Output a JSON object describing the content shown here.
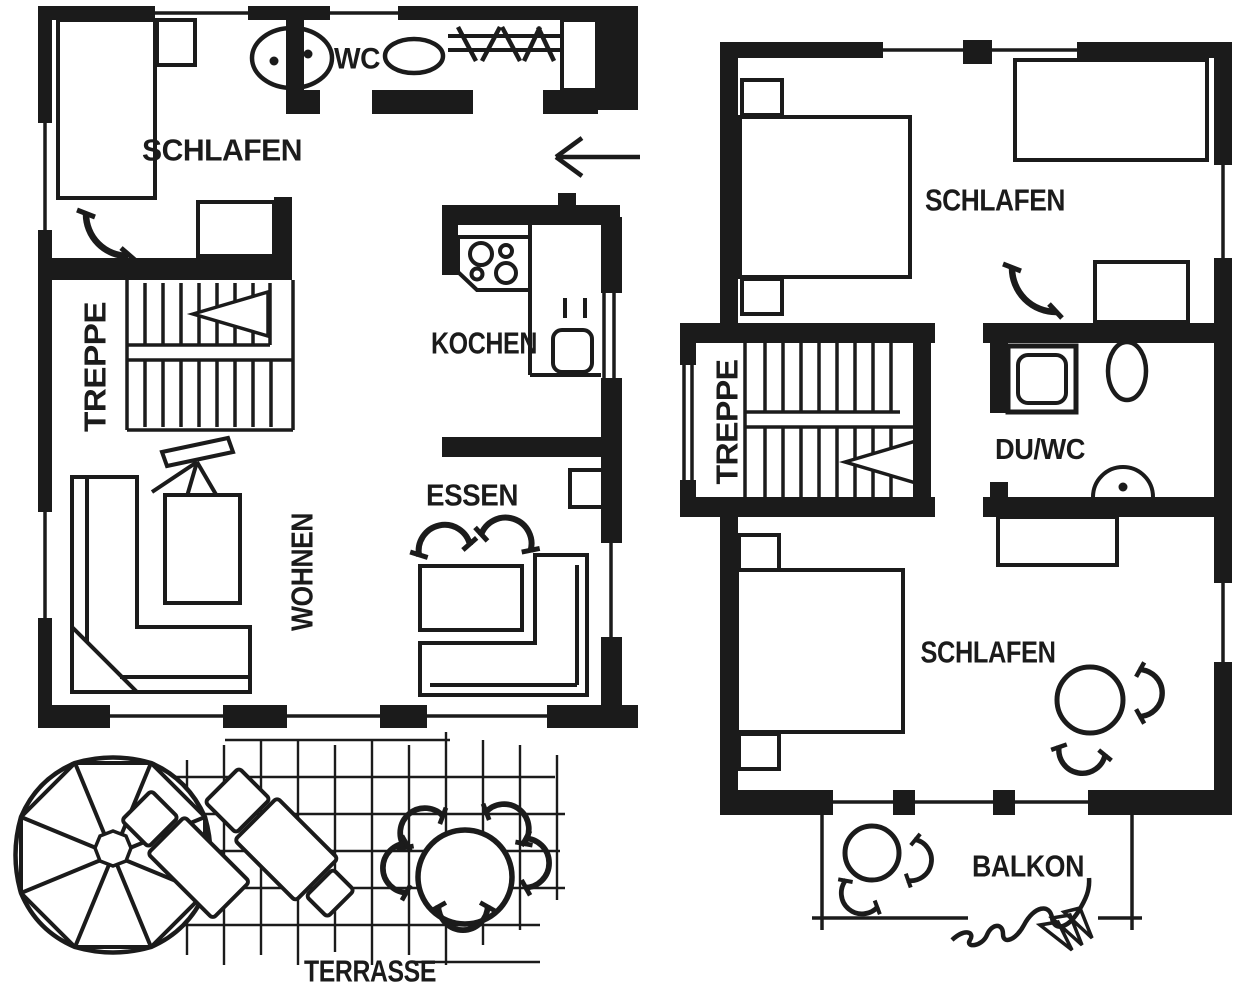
{
  "plan": {
    "background": "#ffffff",
    "ink": "#1b1b1b",
    "floors": [
      {
        "id": "ground-floor",
        "rooms": [
          {
            "label": "SCHLAFEN"
          },
          {
            "label": "WC"
          },
          {
            "label": "TREPPE"
          },
          {
            "label": "KOCHEN"
          },
          {
            "label": "ESSEN"
          },
          {
            "label": "WOHNEN"
          }
        ],
        "outdoor": {
          "label": "TERRASSE"
        }
      },
      {
        "id": "upper-floor",
        "rooms": [
          {
            "label": "SCHLAFEN"
          },
          {
            "label": "TREPPE"
          },
          {
            "label": "DU/WC"
          },
          {
            "label": "SCHLAFEN"
          }
        ],
        "outdoor": {
          "label": "BALKON"
        }
      }
    ],
    "icons": {
      "entrance": "arrow-left-icon",
      "stairs_direction": "triangle-arrow-icon",
      "bed": "bed-icon",
      "washbasin": "basin-circle-dot-icon",
      "toilet": "oval-toilet-icon",
      "shower": "square-shower-icon",
      "wardrobe": "rail-with-hangers-icon",
      "stove": "four-burner-stove-icon",
      "sink": "rounded-sink-icon",
      "sofa": "l-sofa-icon",
      "tv": "tv-on-stand-icon",
      "chair": "arc-chair-icon",
      "parasol": "octagon-umbrella-icon",
      "lounger": "sun-lounger-icon",
      "plant": "squiggle-plant-icon"
    }
  }
}
